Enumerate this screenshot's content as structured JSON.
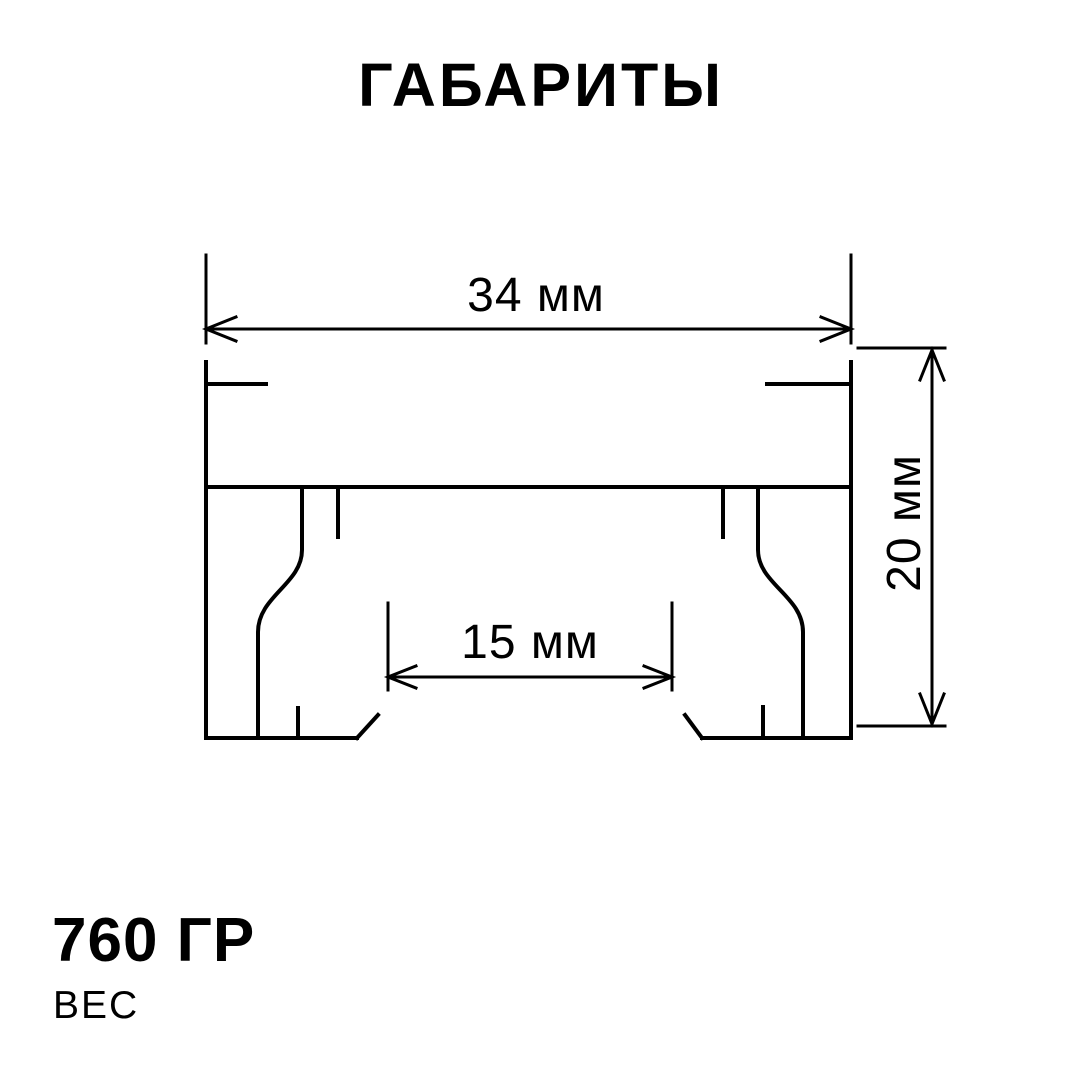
{
  "title": "ГАБАРИТЫ",
  "colors": {
    "line": "#000000",
    "background": "#ffffff"
  },
  "dimensions": {
    "overall_width": "34 мм",
    "inner_width": "15 мм",
    "height": "20 мм"
  },
  "weight": {
    "value": "760 ГР",
    "label": "ВЕС"
  }
}
